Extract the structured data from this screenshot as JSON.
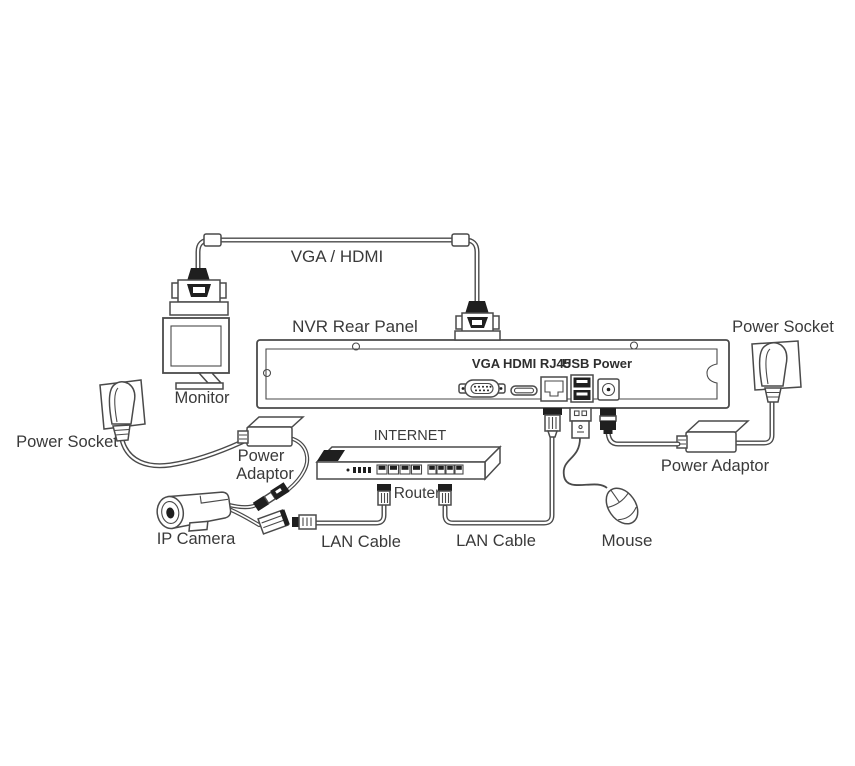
{
  "diagram_type": "nvr-connection-diagram",
  "colors": {
    "line": "#4a4a4a",
    "dark_fill": "#1f1f1f",
    "text": "#3a3a3a",
    "background": "#ffffff"
  },
  "labels": {
    "cable_top": "VGA / HDMI",
    "nvr": "NVR Rear Panel",
    "monitor": "Monitor",
    "power_socket_left": "Power Socket",
    "power_socket_right": "Power Socket",
    "adaptor_left_line1": "Power",
    "adaptor_left_line2": "Adaptor",
    "adaptor_right": "Power Adaptor",
    "camera": "IP Camera",
    "internet": "INTERNET",
    "router": "Router",
    "lan_left": "LAN Cable",
    "lan_right": "LAN Cable",
    "mouse": "Mouse",
    "ports": {
      "vga": "VGA",
      "hdmi_rj45": "HDMI RJ45",
      "usb_power": "USB Power"
    }
  }
}
